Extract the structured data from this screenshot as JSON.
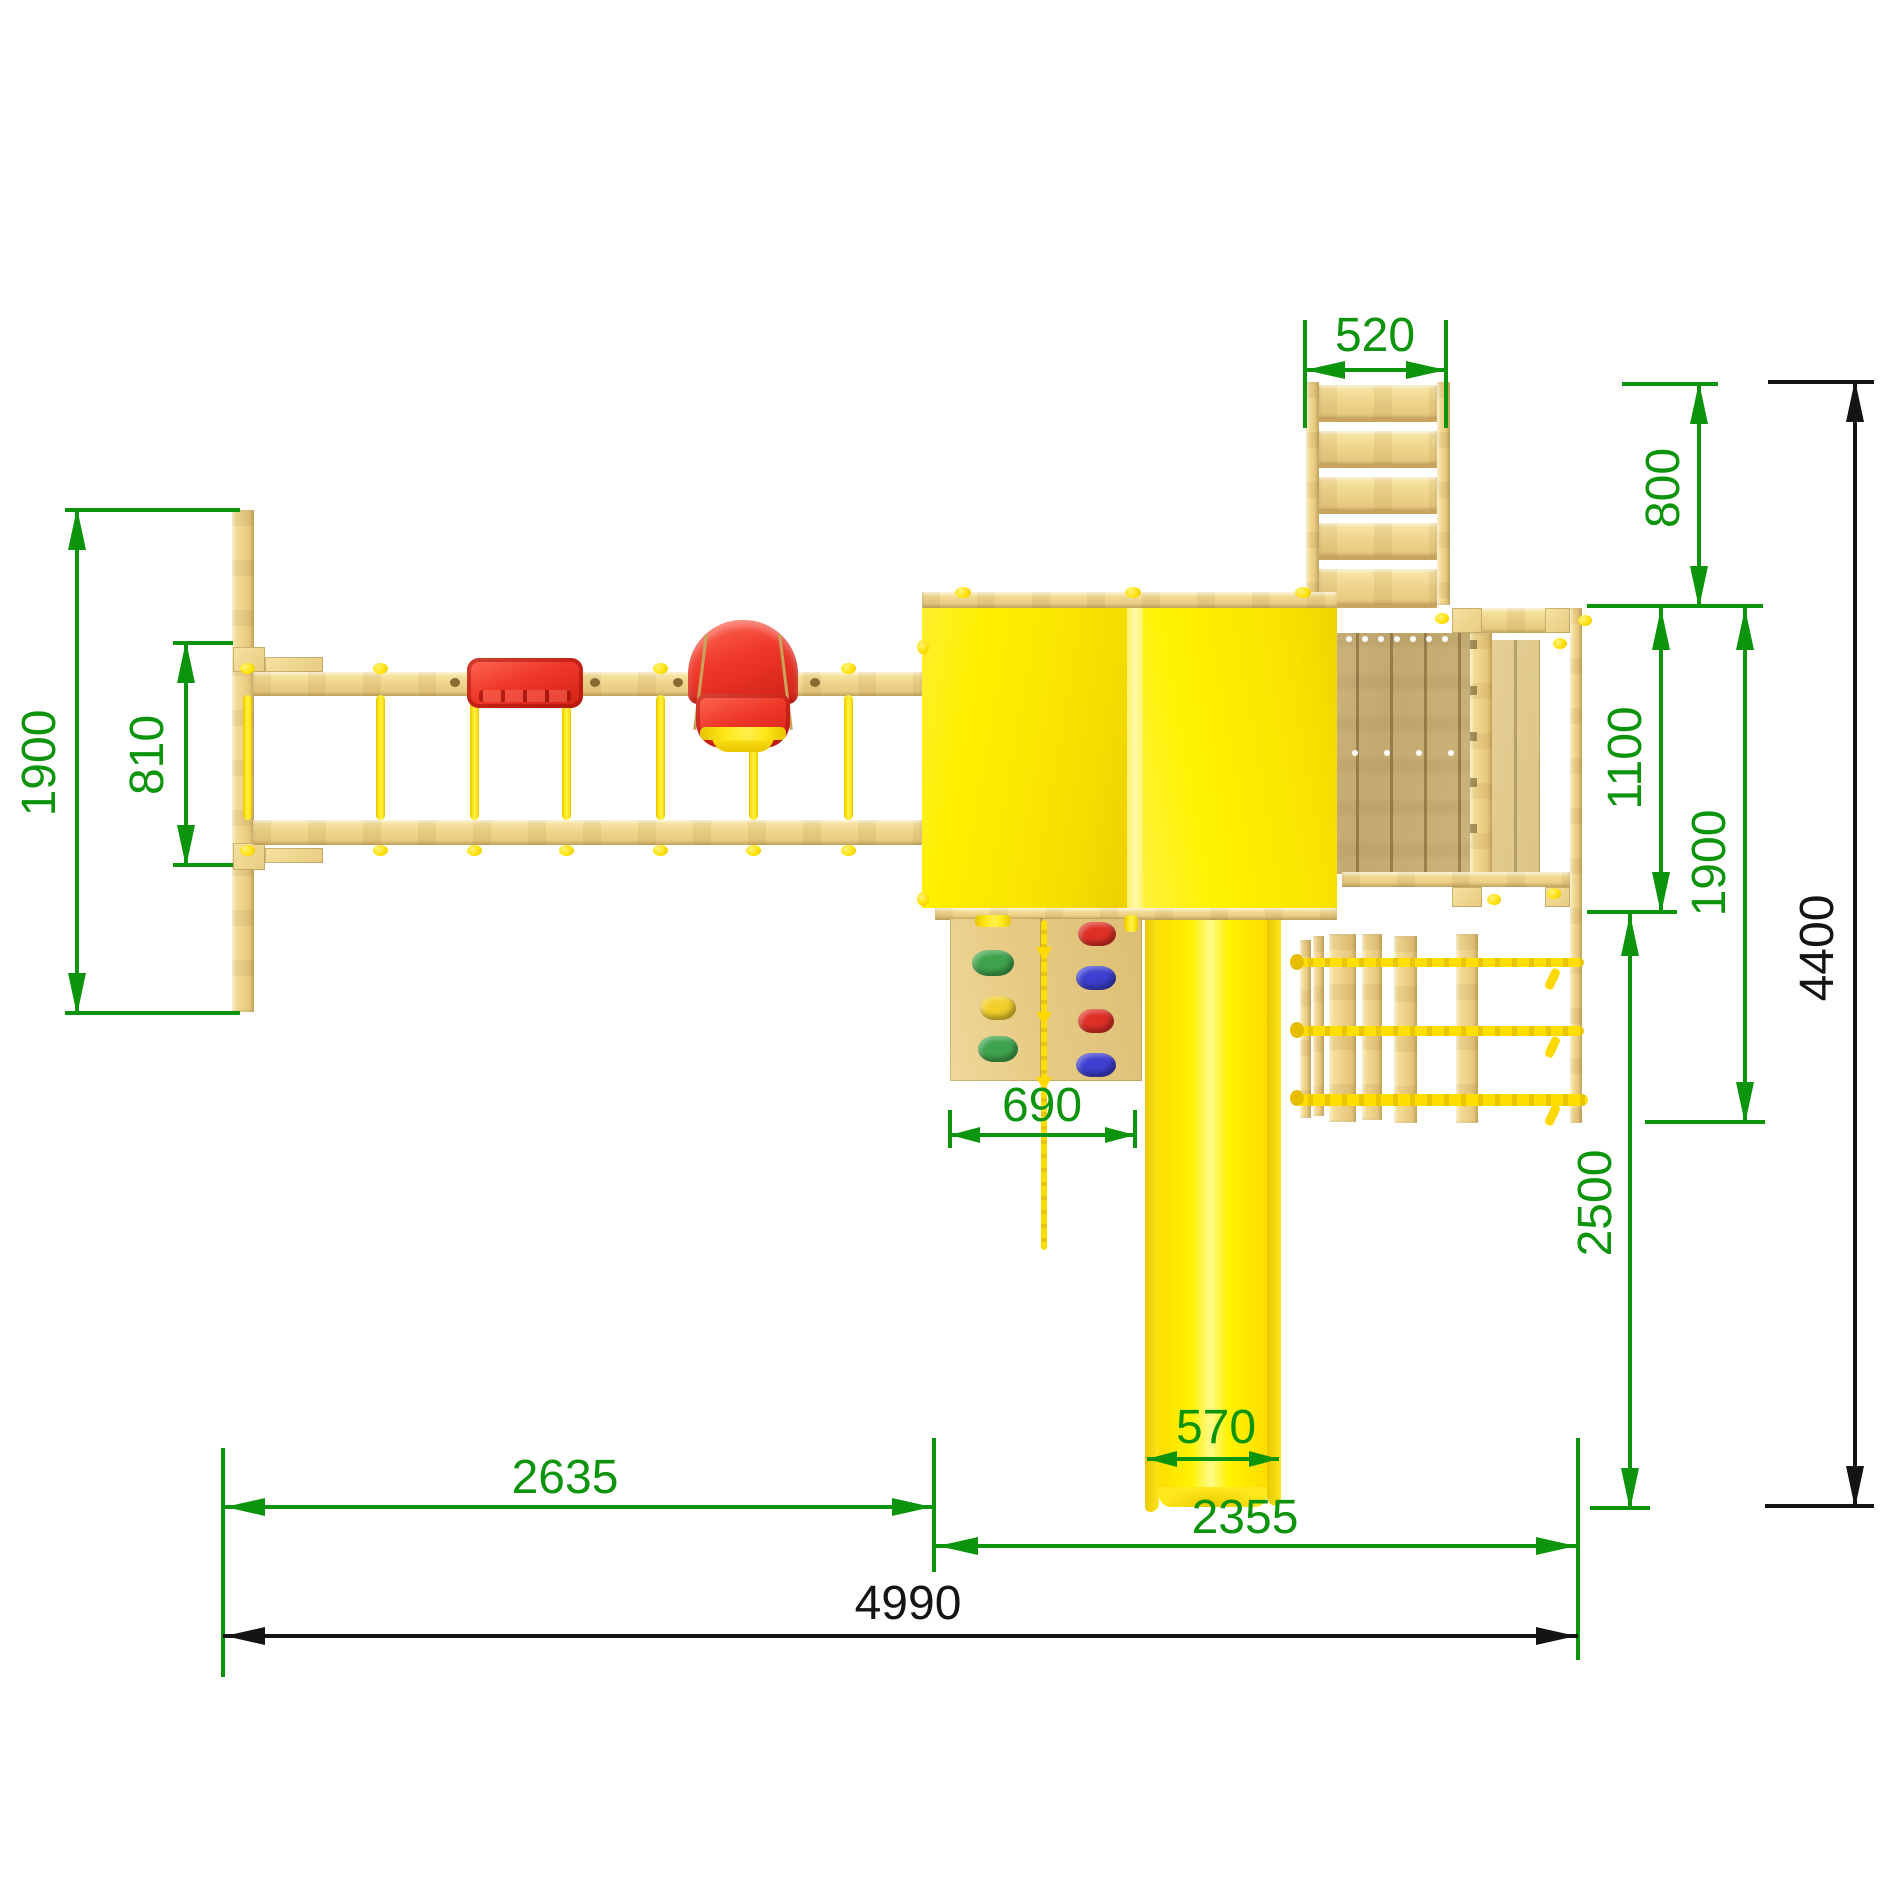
{
  "drawing": {
    "kind": "technical top-view drawing",
    "subject": "wooden playground set with swings, playhouse tower, slide, climbing wall, ladder and rope net"
  },
  "colors": {
    "dimension_green": "#0d940d",
    "dimension_black": "#141414",
    "wood_light": "#f2d996",
    "wood_deck": "#c6ad74",
    "plastic_yellow": "#fff300",
    "plastic_red": "#ef382a",
    "hold_green": "#3fa34d",
    "hold_yellow": "#f2cf2a",
    "hold_red": "#df2f26",
    "hold_blue": "#3d3fd0",
    "background": "#ffffff"
  },
  "dimensions": {
    "swing_depth": "1900",
    "swing_bay_spacing": "810",
    "ladder_width": "520",
    "ladder_depth": "800",
    "balcony_depth": "1100",
    "tower_depth": "1900",
    "slide_run": "2500",
    "total_depth": "4400",
    "swing_section_width": "2635",
    "tower_section_width": "2355",
    "total_width": "4990",
    "climbing_wall_width": "690",
    "slide_width": "570"
  }
}
